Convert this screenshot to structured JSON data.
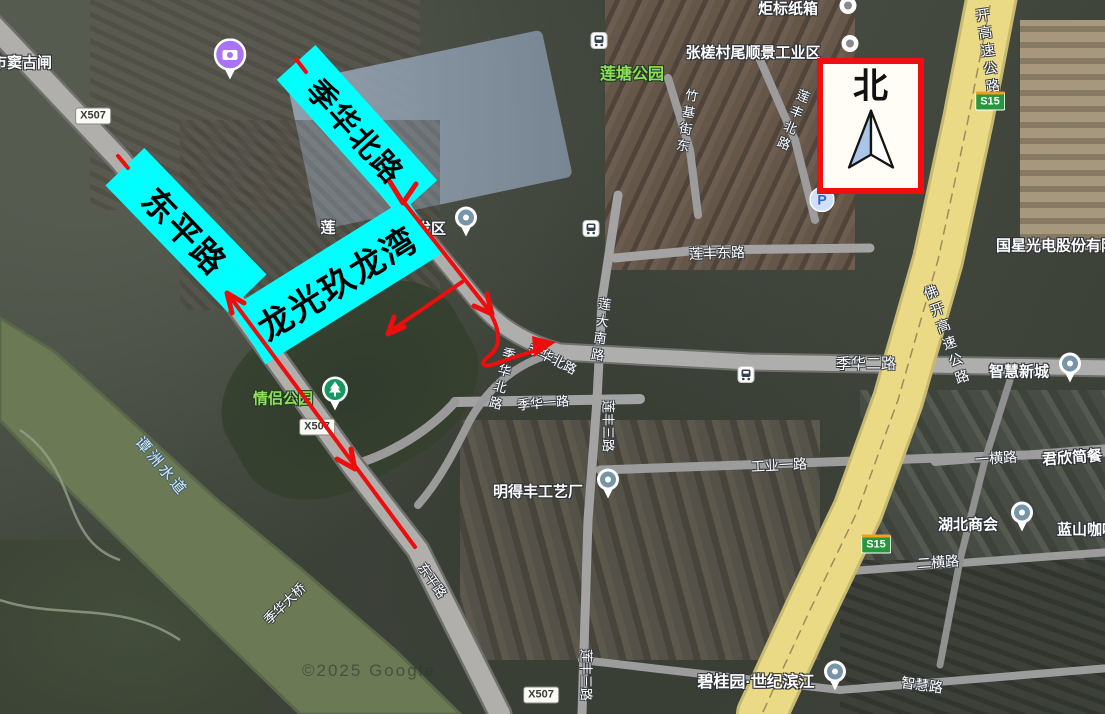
{
  "colors": {
    "annotation_red": "#ee0d0d",
    "annotation_cyan": "#00ffff",
    "north_border": "#f10e0e",
    "north_arrow_fill": "#a9c6e8",
    "highway_fill": "#ead985",
    "river_fill": "#6b7a55",
    "park_label": "#8fdf5a",
    "water_label": "#d4e9f5",
    "expressway_shield_green": "#27963c",
    "expressway_shield_stripe": "#f0a01e",
    "camera_poi_purple": "#a873f5",
    "park_poi_green": "#16995f",
    "parking_blue": "#2e62d9",
    "pin_inner_blue_gray": "#7795a8",
    "metro_glyph_slate": "#33404f"
  },
  "annotations": {
    "north": {
      "label": "北"
    },
    "cyan": [
      {
        "id": "dongping-lu",
        "text": "东平路",
        "cx": 186,
        "cy": 230,
        "w": 176,
        "h": 54,
        "angle": 46,
        "font": 33
      },
      {
        "id": "jihua-bei-lu",
        "text": "季华北路",
        "cx": 357,
        "cy": 130,
        "w": 182,
        "h": 52,
        "angle": 48,
        "font": 30
      },
      {
        "id": "longguang-jiulongwan",
        "text": "龙光玖龙湾",
        "cx": 336,
        "cy": 281,
        "w": 208,
        "h": 66,
        "angle": -32,
        "font": 34
      }
    ]
  },
  "watermark": {
    "text": "©2025 Google"
  },
  "map": {
    "labels": [
      {
        "text": "市窦古闸",
        "x": 22,
        "y": 62,
        "size": 15,
        "kind": "place",
        "angle": 0
      },
      {
        "text": "炬标纸箱",
        "x": 788,
        "y": 8,
        "size": 15,
        "kind": "place",
        "angle": 0
      },
      {
        "text": "张槎村尾顺景工业区",
        "x": 753,
        "y": 52,
        "size": 15,
        "kind": "place",
        "angle": 0
      },
      {
        "text": "莲塘公园",
        "x": 632,
        "y": 72,
        "size": 16,
        "kind": "park",
        "angle": 0
      },
      {
        "text": "竹基街东",
        "x": 686,
        "y": 122,
        "size": 13,
        "kind": "road",
        "angle": 10,
        "vertical": true
      },
      {
        "text": "莲丰北路",
        "x": 792,
        "y": 121,
        "size": 13,
        "kind": "road",
        "angle": 22,
        "vertical": true
      },
      {
        "text": "开高速公路",
        "x": 988,
        "y": 52,
        "size": 14,
        "kind": "road",
        "angle": -8,
        "vertical": true
      },
      {
        "text": "国星光电股份有限",
        "x": 1056,
        "y": 245,
        "size": 15,
        "kind": "place",
        "angle": 0
      },
      {
        "text": "莲丰东路",
        "x": 717,
        "y": 253,
        "size": 14,
        "kind": "road",
        "angle": -2
      },
      {
        "text": "莲大南路",
        "x": 600,
        "y": 331,
        "size": 13,
        "kind": "road",
        "angle": 8,
        "vertical": true
      },
      {
        "text": "佛开高速公路",
        "x": 947,
        "y": 336,
        "size": 14,
        "kind": "road",
        "angle": -20,
        "vertical": true
      },
      {
        "text": "季华二路",
        "x": 866,
        "y": 363,
        "size": 15,
        "kind": "road",
        "angle": 0
      },
      {
        "text": "智慧新城",
        "x": 1019,
        "y": 371,
        "size": 15,
        "kind": "place",
        "angle": 0
      },
      {
        "text": "季华北路",
        "x": 553,
        "y": 358,
        "size": 13,
        "kind": "road",
        "angle": 27
      },
      {
        "text": "季华北路",
        "x": 501,
        "y": 380,
        "size": 13,
        "kind": "road",
        "angle": 15,
        "vertical": true
      },
      {
        "text": "季华一路",
        "x": 543,
        "y": 402,
        "size": 13,
        "kind": "road",
        "angle": -5
      },
      {
        "text": "莲丰三路",
        "x": 609,
        "y": 426,
        "size": 13,
        "kind": "road",
        "angle": 90
      },
      {
        "text": "工业一路",
        "x": 779,
        "y": 465,
        "size": 14,
        "kind": "road",
        "angle": -3
      },
      {
        "text": "一横路",
        "x": 996,
        "y": 458,
        "size": 14,
        "kind": "road",
        "angle": -4
      },
      {
        "text": "君欣简餐",
        "x": 1072,
        "y": 457,
        "size": 15,
        "kind": "place",
        "angle": -4
      },
      {
        "text": "明得丰工艺厂",
        "x": 538,
        "y": 491,
        "size": 15,
        "kind": "place",
        "angle": 0
      },
      {
        "text": "湖北商会",
        "x": 968,
        "y": 524,
        "size": 15,
        "kind": "place",
        "angle": 0
      },
      {
        "text": "蓝山咖啡",
        "x": 1087,
        "y": 529,
        "size": 15,
        "kind": "place",
        "angle": 0
      },
      {
        "text": "二横路",
        "x": 938,
        "y": 562,
        "size": 14,
        "kind": "road",
        "angle": -4
      },
      {
        "text": "东平路",
        "x": 433,
        "y": 580,
        "size": 13,
        "kind": "road",
        "angle": 55
      },
      {
        "text": "季华大桥",
        "x": 284,
        "y": 603,
        "size": 13,
        "kind": "road",
        "angle": -44
      },
      {
        "text": "谭洲水道",
        "x": 162,
        "y": 466,
        "size": 15,
        "kind": "water",
        "angle": 50
      },
      {
        "text": "情侣公园",
        "x": 283,
        "y": 398,
        "size": 15,
        "kind": "park",
        "angle": 0
      },
      {
        "text": "碧桂园·世纪滨江",
        "x": 756,
        "y": 680,
        "size": 16,
        "kind": "place",
        "angle": 0
      },
      {
        "text": "智慧路",
        "x": 922,
        "y": 685,
        "size": 14,
        "kind": "road",
        "angle": 8
      },
      {
        "text": "莲丰三路",
        "x": 587,
        "y": 675,
        "size": 13,
        "kind": "road",
        "angle": 90
      },
      {
        "text": "莲",
        "x": 328,
        "y": 227,
        "size": 15,
        "kind": "place",
        "angle": 0
      },
      {
        "text": "业开发区",
        "x": 416,
        "y": 228,
        "size": 15,
        "kind": "place",
        "angle": 0
      }
    ],
    "shields": [
      {
        "text": "X507",
        "x": 93,
        "y": 116,
        "kind": "county"
      },
      {
        "text": "X507",
        "x": 317,
        "y": 427,
        "kind": "county"
      },
      {
        "text": "X507",
        "x": 541,
        "y": 695,
        "kind": "county"
      },
      {
        "text": "S15",
        "x": 990,
        "y": 101,
        "kind": "expwy"
      },
      {
        "text": "S15",
        "x": 876,
        "y": 544,
        "kind": "expwy"
      }
    ],
    "pois": [
      {
        "kind": "camera",
        "x": 230,
        "y": 62
      },
      {
        "kind": "park",
        "x": 335,
        "y": 396
      },
      {
        "kind": "metro",
        "x": 599,
        "y": 43
      },
      {
        "kind": "metro",
        "x": 591,
        "y": 231
      },
      {
        "kind": "metro",
        "x": 746,
        "y": 377
      },
      {
        "kind": "parking",
        "x": 822,
        "y": 202
      },
      {
        "kind": "pin",
        "x": 466,
        "y": 224
      },
      {
        "kind": "pin",
        "x": 1070,
        "y": 370
      },
      {
        "kind": "pin",
        "x": 608,
        "y": 486
      },
      {
        "kind": "pin",
        "x": 1022,
        "y": 519
      },
      {
        "kind": "pin",
        "x": 835,
        "y": 678
      },
      {
        "kind": "dot-gray",
        "x": 850,
        "y": 46
      },
      {
        "kind": "dot-gray",
        "x": 848,
        "y": 8
      }
    ]
  }
}
